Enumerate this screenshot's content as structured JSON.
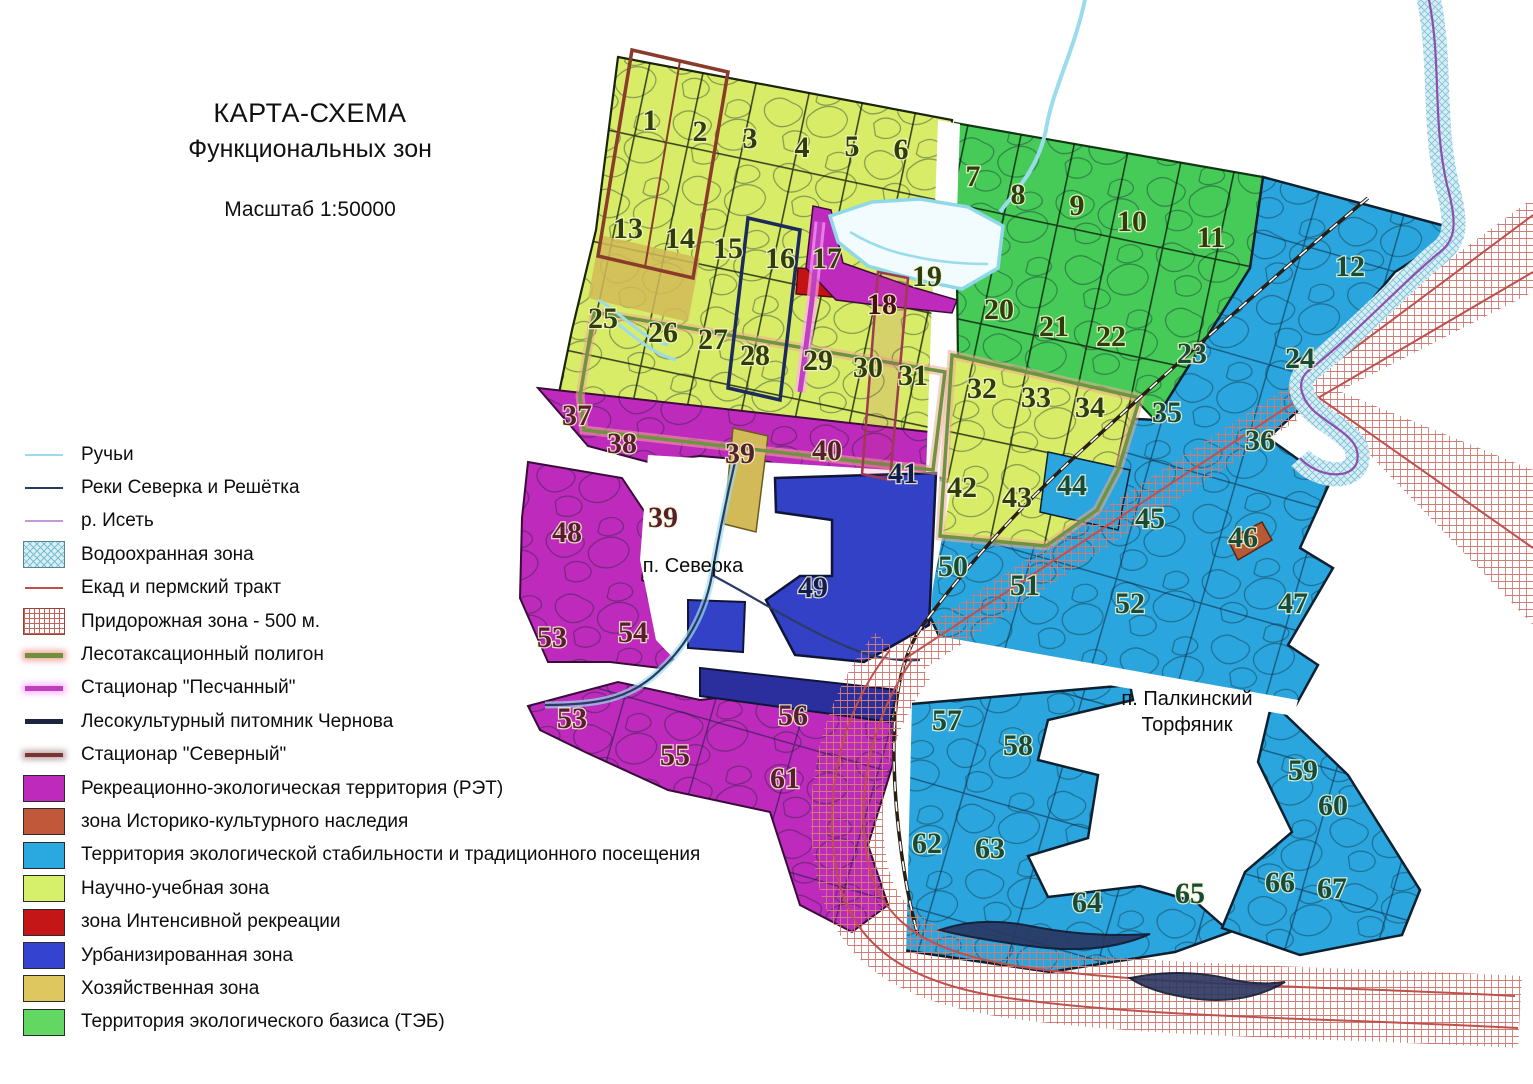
{
  "title": {
    "line1": "КАРТА-СХЕМА",
    "line2": "Функциональных зон",
    "scale": "Масштаб 1:50000"
  },
  "legend": {
    "items": [
      {
        "label": "Ручьи",
        "type": "line",
        "color": "#9adceb",
        "width": 2.5,
        "icon": "stream-line-icon"
      },
      {
        "label": "Реки Северка и Решётка",
        "type": "line",
        "color": "#2b3a64",
        "width": 2.5,
        "icon": "river-line-icon"
      },
      {
        "label": "р. Исеть",
        "type": "line",
        "color": "#c39ad8",
        "width": 2.5,
        "icon": "iset-line-icon"
      },
      {
        "label": "Водоохранная зона",
        "type": "rect-hatch",
        "color": "#74bfd4",
        "icon": "water-protection-swatch-icon"
      },
      {
        "label": "Екад и пермский тракт",
        "type": "line",
        "color": "#c0504d",
        "width": 2.2,
        "icon": "road-line-icon"
      },
      {
        "label": "Придорожная зона - 500 м.",
        "type": "rect-grid",
        "color": "#c4625a",
        "icon": "roadside-zone-swatch-icon"
      },
      {
        "label": "Лесотаксационный полигон",
        "type": "line",
        "color": "#70903c",
        "width": 5,
        "glow": "rgba(240,160,150,0.85)",
        "icon": "forest-taxation-line-icon"
      },
      {
        "label": "Стационар \"Песчанный\"",
        "type": "line",
        "color": "#bf3fbf",
        "width": 5,
        "glow": "rgba(255,170,255,0.75)",
        "icon": "stationar-peschanny-line-icon"
      },
      {
        "label": "Лесокультурный питомник Чернова",
        "type": "line",
        "color": "#1c2440",
        "width": 5,
        "icon": "chernov-nursery-line-icon"
      },
      {
        "label": "Стационар \"Северный\"",
        "type": "line",
        "color": "#7b3433",
        "width": 4.5,
        "glow": "rgba(120,80,80,0.45)",
        "icon": "stationar-severny-line-icon"
      },
      {
        "label": "Рекреационно-экологическая территория (РЭТ)",
        "type": "rect",
        "color": "#be2abc",
        "icon": "ret-swatch-icon"
      },
      {
        "label": "зона Историко-культурного наследия",
        "type": "rect",
        "color": "#c2583a",
        "icon": "heritage-swatch-icon"
      },
      {
        "label": "Территория экологической стабильности и традиционного посещения",
        "type": "rect",
        "color": "#2aa9e0",
        "icon": "eco-stability-swatch-icon"
      },
      {
        "label": "Научно-учебная зона",
        "type": "rect",
        "color": "#d6f06c",
        "icon": "science-zone-swatch-icon"
      },
      {
        "label": "зона Интенсивной рекреации",
        "type": "rect",
        "color": "#c41616",
        "icon": "intensive-recreation-swatch-icon"
      },
      {
        "label": "Урбанизированная зона",
        "type": "rect",
        "color": "#3444d0",
        "icon": "urban-zone-swatch-icon"
      },
      {
        "label": "Хозяйственная зона",
        "type": "rect",
        "color": "#ddc75e",
        "icon": "economic-zone-swatch-icon"
      },
      {
        "label": "Территория экологического базиса (ТЭБ)",
        "type": "rect",
        "color": "#62d862",
        "icon": "teb-swatch-icon"
      }
    ]
  },
  "colors": {
    "science": "#d8ec68",
    "teb": "#46cb58",
    "eco": "#2aa5de",
    "ret": "#be2abc",
    "urban": "#3341c6",
    "urban_dark": "#2b2f9e",
    "economic": "#d2ba58",
    "intensive": "#c21414",
    "heritage": "#b65a35",
    "lake_fill": "#f2fbfd",
    "lake_edge": "#8fd8e8",
    "stream": "#9adceb",
    "river_dark": "#2b3a64",
    "iset": "#8d4fae",
    "water_band": "#d9edf4",
    "road_red": "#c0504d",
    "rail": "#2a1e14",
    "glow_green": "#6f9440",
    "glow_pink": "rgba(240,170,150,0.55)",
    "station_north": "#8a3b2b",
    "station_band": "#9e3a52",
    "nursery": "#1c2a5e",
    "peschanny": "#c13fc1",
    "border_dark": "#141c24",
    "pond": "#2b3660",
    "white": "#ffffff"
  },
  "map": {
    "settlements": [
      {
        "lines": [
          "п. Северка"
        ],
        "x": 693,
        "y": 572
      },
      {
        "lines": [
          "п. Палкинский",
          "Торфяник"
        ],
        "x": 1187,
        "y": 705
      }
    ],
    "zones": [
      {
        "n": "1",
        "x": 650,
        "y": 130,
        "tone": "olive"
      },
      {
        "n": "2",
        "x": 700,
        "y": 141,
        "tone": "olive"
      },
      {
        "n": "3",
        "x": 750,
        "y": 148,
        "tone": "olive"
      },
      {
        "n": "4",
        "x": 802,
        "y": 157,
        "tone": "olive"
      },
      {
        "n": "5",
        "x": 852,
        "y": 156,
        "tone": "olive"
      },
      {
        "n": "6",
        "x": 901,
        "y": 159,
        "tone": "olive"
      },
      {
        "n": "7",
        "x": 973,
        "y": 186,
        "tone": "olive"
      },
      {
        "n": "8",
        "x": 1018,
        "y": 204,
        "tone": "olive"
      },
      {
        "n": "9",
        "x": 1077,
        "y": 215,
        "tone": "olive"
      },
      {
        "n": "10",
        "x": 1132,
        "y": 231,
        "tone": "olive"
      },
      {
        "n": "11",
        "x": 1211,
        "y": 247,
        "tone": "olive"
      },
      {
        "n": "12",
        "x": 1350,
        "y": 276,
        "tone": "teal"
      },
      {
        "n": "13",
        "x": 628,
        "y": 238,
        "tone": "olive"
      },
      {
        "n": "14",
        "x": 680,
        "y": 248,
        "tone": "olive"
      },
      {
        "n": "15",
        "x": 728,
        "y": 258,
        "tone": "olive"
      },
      {
        "n": "16",
        "x": 780,
        "y": 268,
        "tone": "olive"
      },
      {
        "n": "17",
        "x": 827,
        "y": 268,
        "tone": "olive"
      },
      {
        "n": "18",
        "x": 882,
        "y": 314,
        "tone": "red"
      },
      {
        "n": "19",
        "x": 927,
        "y": 286,
        "tone": "olive"
      },
      {
        "n": "20",
        "x": 999,
        "y": 319,
        "tone": "olive"
      },
      {
        "n": "21",
        "x": 1054,
        "y": 336,
        "tone": "olive"
      },
      {
        "n": "22",
        "x": 1111,
        "y": 346,
        "tone": "olive"
      },
      {
        "n": "23",
        "x": 1192,
        "y": 363,
        "tone": "teal"
      },
      {
        "n": "24",
        "x": 1300,
        "y": 368,
        "tone": "teal"
      },
      {
        "n": "25",
        "x": 603,
        "y": 328,
        "tone": "olive"
      },
      {
        "n": "26",
        "x": 663,
        "y": 342,
        "tone": "olive"
      },
      {
        "n": "27",
        "x": 713,
        "y": 349,
        "tone": "olive"
      },
      {
        "n": "28",
        "x": 755,
        "y": 365,
        "tone": "olive"
      },
      {
        "n": "29",
        "x": 818,
        "y": 370,
        "tone": "olive"
      },
      {
        "n": "30",
        "x": 868,
        "y": 377,
        "tone": "olive"
      },
      {
        "n": "31",
        "x": 913,
        "y": 385,
        "tone": "olive"
      },
      {
        "n": "32",
        "x": 982,
        "y": 398,
        "tone": "olive"
      },
      {
        "n": "33",
        "x": 1036,
        "y": 407,
        "tone": "olive"
      },
      {
        "n": "34",
        "x": 1090,
        "y": 417,
        "tone": "olive"
      },
      {
        "n": "35",
        "x": 1167,
        "y": 422,
        "tone": "teal"
      },
      {
        "n": "36",
        "x": 1260,
        "y": 450,
        "tone": "teal"
      },
      {
        "n": "37",
        "x": 577,
        "y": 425,
        "tone": "maroon"
      },
      {
        "n": "38",
        "x": 622,
        "y": 453,
        "tone": "maroon"
      },
      {
        "n": "39",
        "x": 740,
        "y": 463,
        "tone": "maroon"
      },
      {
        "n": "39",
        "x": 663,
        "y": 527,
        "tone": "maroon"
      },
      {
        "n": "40",
        "x": 827,
        "y": 460,
        "tone": "maroon"
      },
      {
        "n": "41",
        "x": 903,
        "y": 483,
        "tone": "navy"
      },
      {
        "n": "42",
        "x": 962,
        "y": 497,
        "tone": "olive"
      },
      {
        "n": "43",
        "x": 1017,
        "y": 507,
        "tone": "olive"
      },
      {
        "n": "44",
        "x": 1072,
        "y": 495,
        "tone": "teal"
      },
      {
        "n": "45",
        "x": 1150,
        "y": 528,
        "tone": "teal"
      },
      {
        "n": "46",
        "x": 1243,
        "y": 547,
        "tone": "teal"
      },
      {
        "n": "47",
        "x": 1293,
        "y": 613,
        "tone": "teal"
      },
      {
        "n": "48",
        "x": 567,
        "y": 542,
        "tone": "maroon"
      },
      {
        "n": "49",
        "x": 813,
        "y": 597,
        "tone": "navy"
      },
      {
        "n": "50",
        "x": 953,
        "y": 576,
        "tone": "teal"
      },
      {
        "n": "51",
        "x": 1025,
        "y": 595,
        "tone": "teal"
      },
      {
        "n": "52",
        "x": 1130,
        "y": 613,
        "tone": "teal"
      },
      {
        "n": "53",
        "x": 552,
        "y": 647,
        "tone": "maroon"
      },
      {
        "n": "53",
        "x": 572,
        "y": 728,
        "tone": "maroon"
      },
      {
        "n": "54",
        "x": 633,
        "y": 642,
        "tone": "maroon"
      },
      {
        "n": "55",
        "x": 675,
        "y": 765,
        "tone": "maroon"
      },
      {
        "n": "56",
        "x": 793,
        "y": 725,
        "tone": "maroon"
      },
      {
        "n": "57",
        "x": 947,
        "y": 730,
        "tone": "teal"
      },
      {
        "n": "58",
        "x": 1018,
        "y": 755,
        "tone": "teal"
      },
      {
        "n": "59",
        "x": 1303,
        "y": 780,
        "tone": "teal"
      },
      {
        "n": "60",
        "x": 1333,
        "y": 815,
        "tone": "teal"
      },
      {
        "n": "61",
        "x": 785,
        "y": 788,
        "tone": "maroon"
      },
      {
        "n": "62",
        "x": 927,
        "y": 853,
        "tone": "teal"
      },
      {
        "n": "63",
        "x": 990,
        "y": 858,
        "tone": "teal"
      },
      {
        "n": "64",
        "x": 1087,
        "y": 912,
        "tone": "teal"
      },
      {
        "n": "65",
        "x": 1190,
        "y": 903,
        "tone": "teal"
      },
      {
        "n": "66",
        "x": 1280,
        "y": 892,
        "tone": "teal"
      },
      {
        "n": "67",
        "x": 1332,
        "y": 898,
        "tone": "teal"
      }
    ]
  }
}
